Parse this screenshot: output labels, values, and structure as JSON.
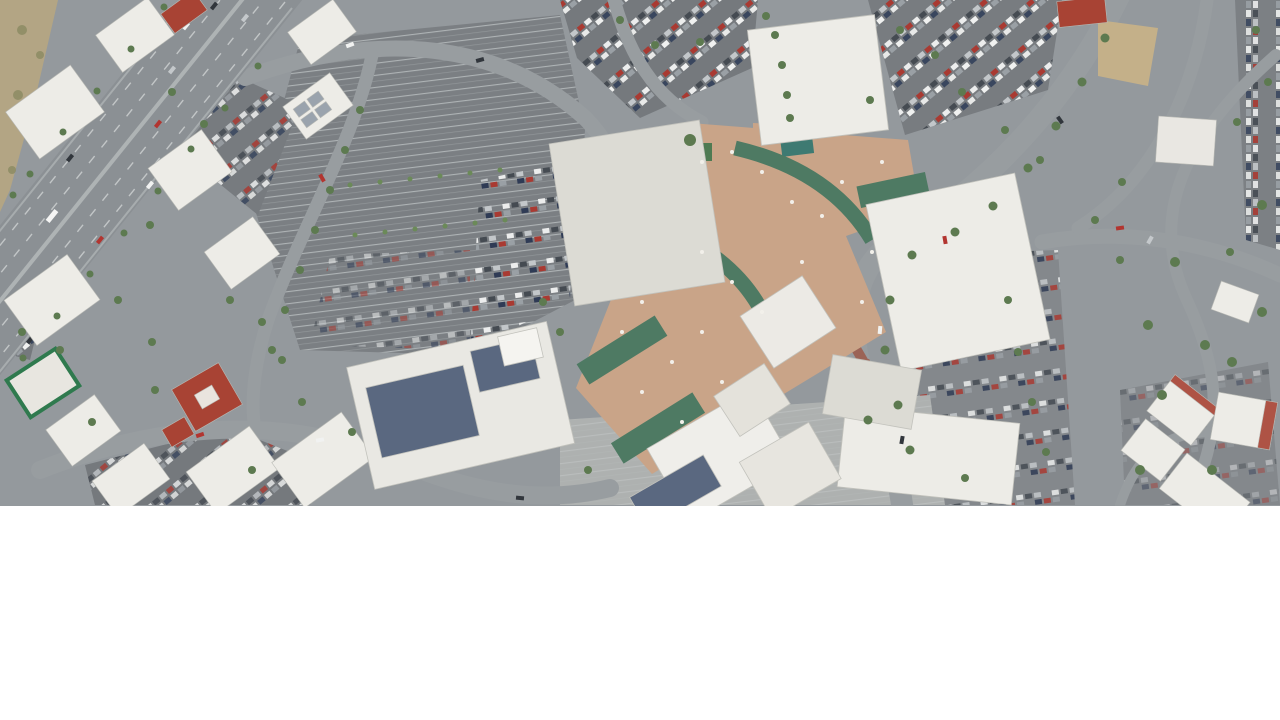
{
  "window": {
    "width": 1280,
    "height": 720
  },
  "scene": {
    "kind": "satellite-aerial-photograph",
    "subject": "Overhead satellite view of a suburban shopping mall and surrounding retail district",
    "visible_text": [],
    "watermark": null,
    "layout_note": "Photograph fills the top band of the page; the remainder below is blank white",
    "features": [
      {
        "id": "arterial-highway",
        "desc": "Wide multi-lane divided road running diagonally down the left side with traffic"
      },
      {
        "id": "hillside-dirt",
        "desc": "Tan dirt slope strip in the top-left corner"
      },
      {
        "id": "left-retail-pads",
        "desc": "Cluster of small white-roof and red-tile-roof buildings along the highway"
      },
      {
        "id": "central-parking-lot",
        "desc": "Large parking lot, mostly empty stalls with clusters of parked cars"
      },
      {
        "id": "mall-complex",
        "desc": "Tan mall roof with curved green walkway canopies connecting white anchor stores"
      },
      {
        "id": "anchor-nw",
        "desc": "Large light-gray anchor store roof left of the mall core"
      },
      {
        "id": "anchor-top",
        "desc": "Large white roof at top center with tan courtyard and small teal pool"
      },
      {
        "id": "anchor-east",
        "desc": "Large white anchor store roof on the right side of the mall"
      },
      {
        "id": "solar-roof-store",
        "desc": "Anchor store at bottom center with dark blue rooftop solar panels"
      },
      {
        "id": "east-roads",
        "desc": "Curved tree-lined roads, parking and outparcel buildings on the right third"
      },
      {
        "id": "bottom-right-pads",
        "desc": "Small white retail buildings with red tile accents at bottom right"
      }
    ]
  },
  "colors": {
    "asphalt": "#94999d",
    "lot": "#74787c",
    "lot_light": "#84888c",
    "plaza": "#aeb1b0",
    "highway": "#8b9094",
    "lane": "#e9ebeb",
    "roof_white": "#edece7",
    "roof_offwhite": "#dcdbd4",
    "roof_tan": "#c9a488",
    "canopy": "#4e7a63",
    "solar": "#5a6880",
    "tile_red": "#a84334",
    "dirt": "#b3a584",
    "dirt_lot": "#c4b089",
    "tree": "#5d7a50",
    "tree_light": "#6b8a58",
    "pool": "#3e7a72",
    "grass": "#4e7a52"
  }
}
